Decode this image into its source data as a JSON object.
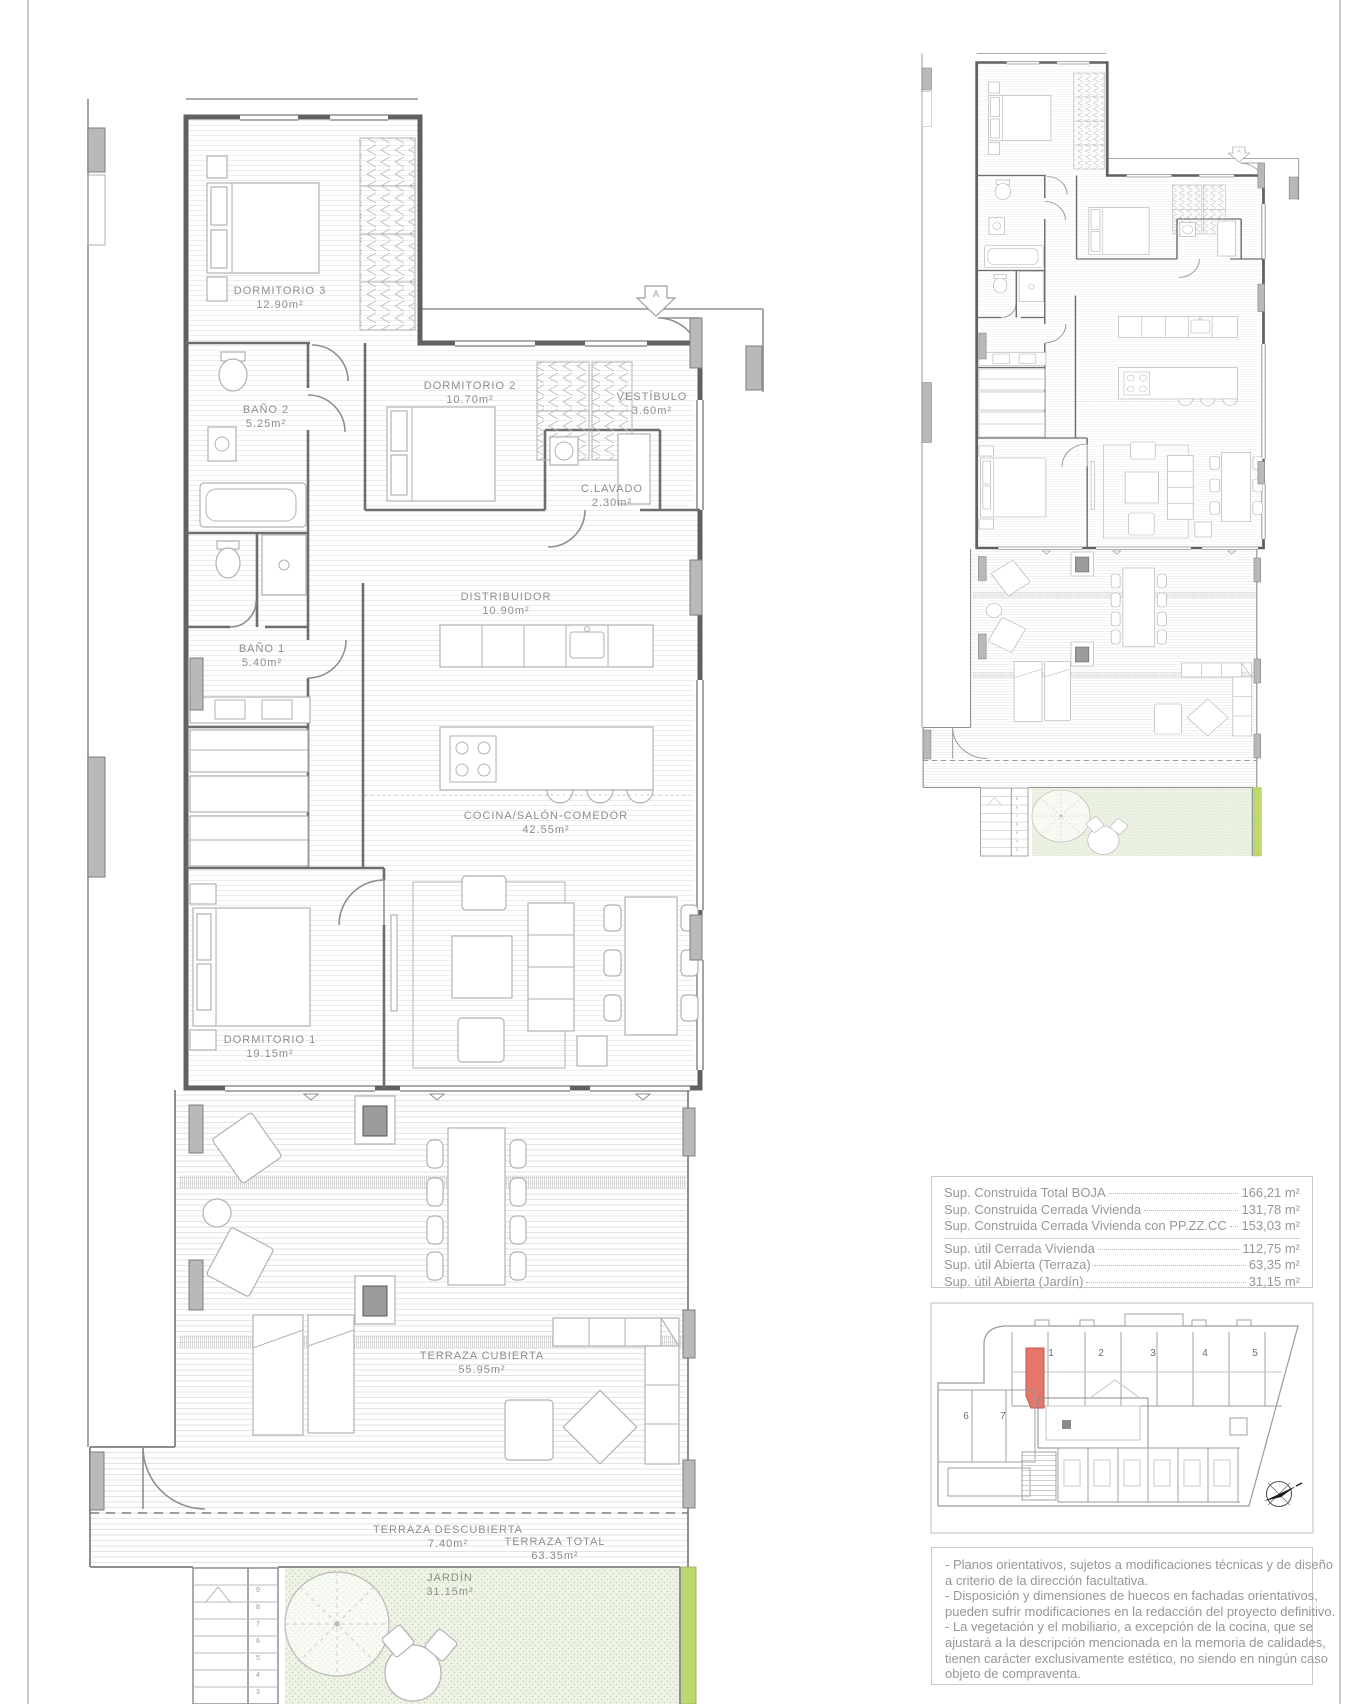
{
  "page": {
    "background": "#ffffff",
    "border_color": "#bdbdbd"
  },
  "main_plan": {
    "rooms": [
      {
        "name": "DORMITORIO 3",
        "area": "12.90m²"
      },
      {
        "name": "BAÑO 2",
        "area": "5.25m²"
      },
      {
        "name": "DORMITORIO 2",
        "area": "10.70m²"
      },
      {
        "name": "VESTÍBULO",
        "area": "3.60m²"
      },
      {
        "name": "C.LAVADO",
        "area": "2.30m²"
      },
      {
        "name": "DISTRIBUIDOR",
        "area": "10.90m²"
      },
      {
        "name": "BAÑO 1",
        "area": "5.40m²"
      },
      {
        "name": "COCINA/SALÓN-COMEDOR",
        "area": "42.55m²"
      },
      {
        "name": "DORMITORIO 1",
        "area": "19.15m²"
      },
      {
        "name": "TERRAZA CUBIERTA",
        "area": "55.95m²"
      },
      {
        "name": "TERRAZA DESCUBIERTA",
        "area": "7.40m²"
      },
      {
        "name": "TERRAZA TOTAL",
        "area": "63.35m²"
      },
      {
        "name": "JARDÍN",
        "area": "31.15m²"
      }
    ],
    "section_marker": "A",
    "stair_steps": [
      "9",
      "8",
      "7",
      "6",
      "5",
      "4",
      "3"
    ]
  },
  "areas_table": {
    "rows": [
      {
        "label": "Sup. Construida Total BOJA",
        "value": "166,21 m²"
      },
      {
        "label": "Sup. Construida Cerrada Vivienda",
        "value": "131,78 m²"
      },
      {
        "label": "Sup. Construida Cerrada Vivienda con PP.ZZ.CC",
        "value": "153,03 m²"
      },
      {
        "label": "Sup. útil Cerrada Vivienda",
        "value": "112,75 m²"
      },
      {
        "label": "Sup. útil Abierta (Terraza)",
        "value": "63,35 m²"
      },
      {
        "label": "Sup. útil Abierta (Jardín)",
        "value": "31,15 m²"
      }
    ]
  },
  "site_plan": {
    "units": [
      "1",
      "2",
      "3",
      "4",
      "5",
      "6",
      "7"
    ],
    "highlight_color": "#e6766c"
  },
  "disclaimer": {
    "lines": [
      "- Planos orientativos, sujetos a modificaciones técnicas y de diseño",
      "a criterio de la dirección facultativa.",
      "- Disposición y dimensiones de huecos en fachadas orientativos,",
      "pueden sufrir modificaciones en la redacción del proyecto definitivo.",
      "- La vegetación y el mobiliario, a excepción de la cocina, que se",
      "ajustará a la descripción mencionada en la memoria de calidades,",
      "tienen carácter exclusivamente estético, no siendo en ningún caso",
      "objeto de compraventa."
    ]
  },
  "colors": {
    "wall": "#616161",
    "line": "#8f8f8f",
    "label_text": "#8d8d8d",
    "table_text": "#97979b",
    "garden_fill": "#eff3e6",
    "garden_stripe": "#bcd96e",
    "highlight_red": "#e6766c",
    "pilaster": "#b9b9b9"
  }
}
